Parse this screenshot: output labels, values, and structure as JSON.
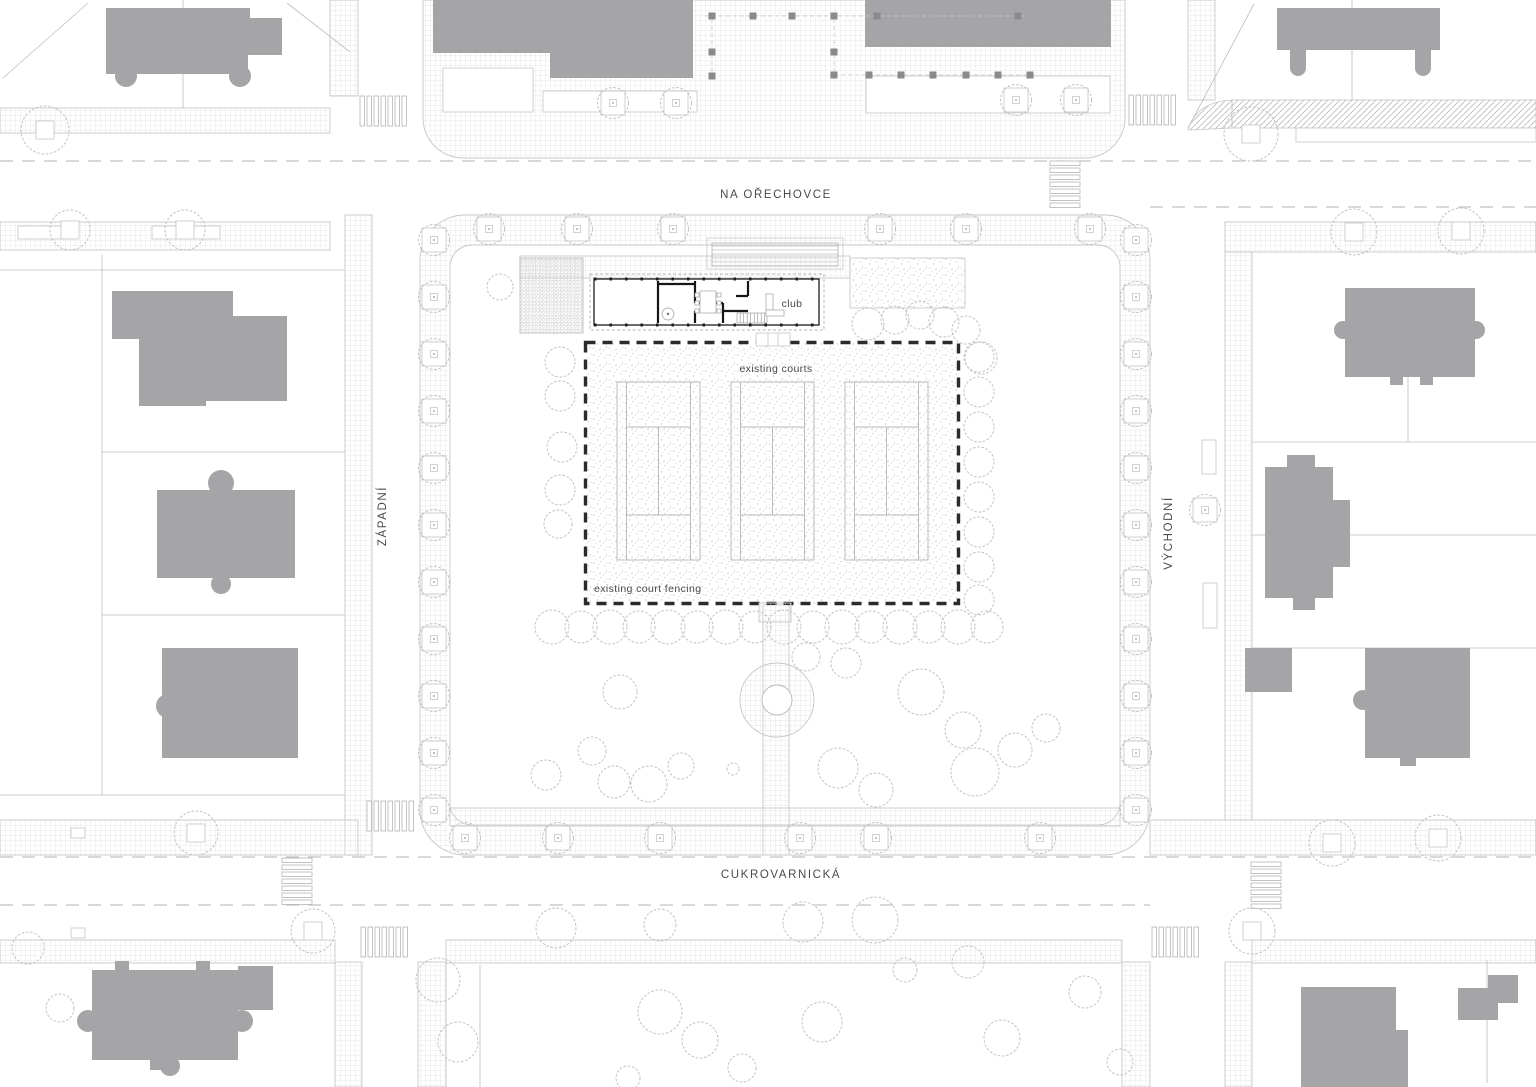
{
  "plan": {
    "type": "architectural site plan",
    "labels": {
      "street_top": "NA OŘECHOVCE",
      "street_bottom": "CUKROVARNICKÁ",
      "street_west": "ZÁPADNÍ",
      "street_east": "VÝCHODNÍ",
      "club": "club",
      "existing_courts": "existing courts",
      "existing_court_fencing": "existing court fencing"
    },
    "features": {
      "tennis_courts": 3,
      "club_building": 1
    },
    "colors": {
      "background": "#ffffff",
      "building_fill": "#a5a5a7",
      "line_light": "#c6c6c8",
      "hatch_line": "#e3e3e5",
      "fence_dash": "#2b2b2b",
      "club_wall": "#161616",
      "label_text": "#4a4a4a",
      "bollard": "#8a8a8c"
    }
  }
}
